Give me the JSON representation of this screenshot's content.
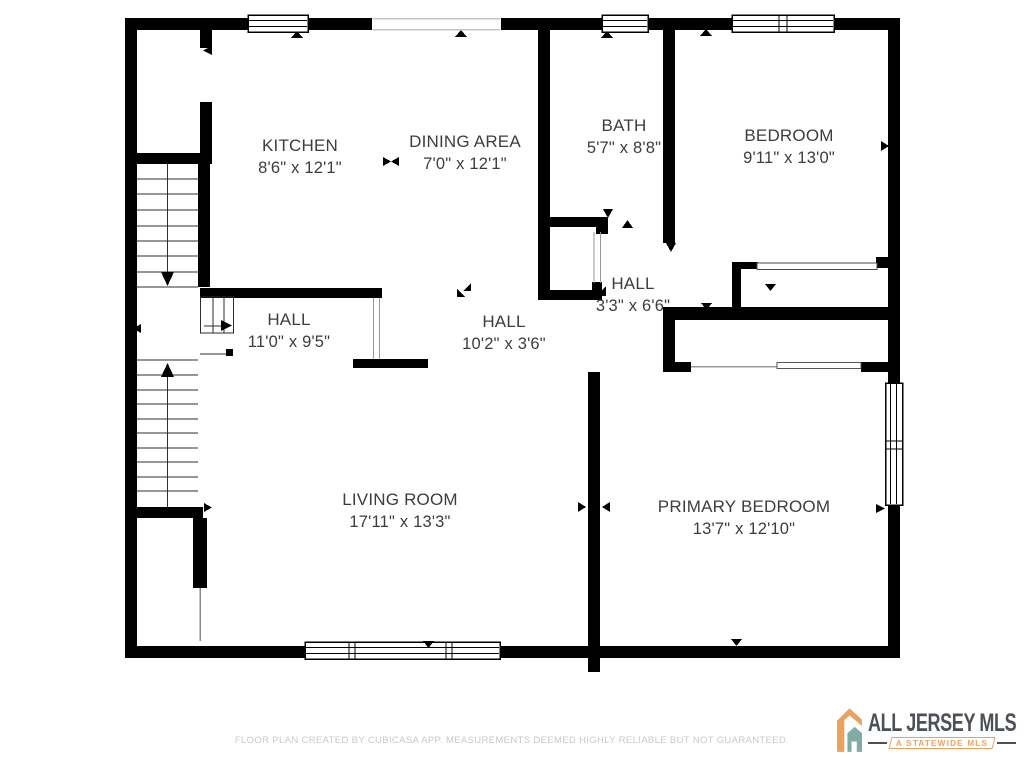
{
  "plan": {
    "rooms": {
      "kitchen": {
        "name": "KITCHEN",
        "dims": "8'6\" x 12'1\""
      },
      "dining": {
        "name": "DINING AREA",
        "dims": "7'0\" x 12'1\""
      },
      "bath": {
        "name": "BATH",
        "dims": "5'7\" x 8'8\""
      },
      "bedroom": {
        "name": "BEDROOM",
        "dims": "9'11\" x 13'0\""
      },
      "hall_small": {
        "name": "HALL",
        "dims": "3'3\" x 6'6\""
      },
      "hall_left": {
        "name": "HALL",
        "dims": "11'0\" x 9'5\""
      },
      "hall_mid": {
        "name": "HALL",
        "dims": "10'2\" x 3'6\""
      },
      "living": {
        "name": "LIVING ROOM",
        "dims": "17'11\" x 13'3\""
      },
      "primary": {
        "name": "PRIMARY BEDROOM",
        "dims": "13'7\" x 12'10\""
      }
    }
  },
  "footer": {
    "disclaimer": "FLOOR PLAN CREATED BY CUBICASA APP. MEASUREMENTS DEEMED HIGHLY RELIABLE BUT NOT GUARANTEED."
  },
  "logo": {
    "title": "ALL JERSEY MLS",
    "tagline": "A STATEWIDE MLS"
  },
  "colors": {
    "wall": "#000000",
    "label_text": "#3d3d3d",
    "footer_text": "#c9c9c9",
    "opening_line": "#9a9a9a",
    "logo_text": "#4b5157",
    "logo_orange": "#eca25c",
    "logo_teal": "#7fada4"
  }
}
